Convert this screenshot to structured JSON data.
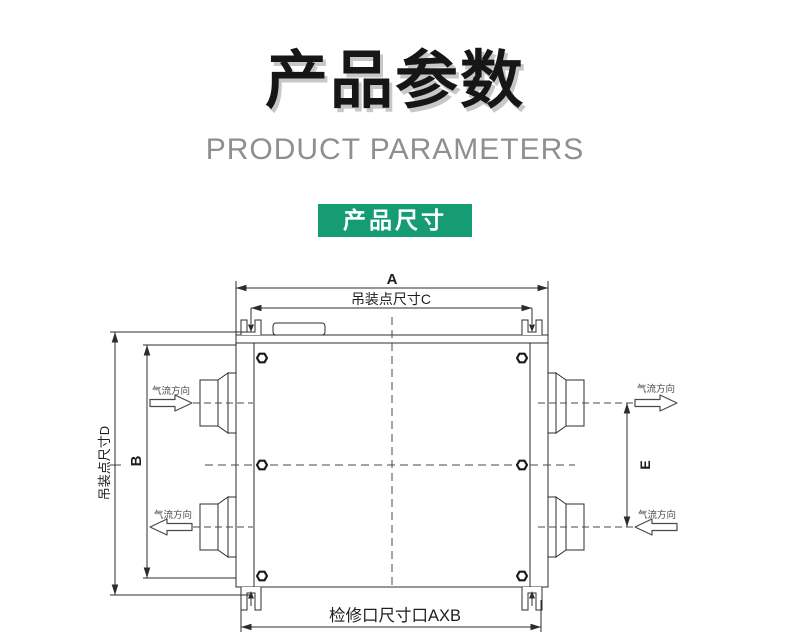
{
  "header": {
    "title": "产品参数",
    "subtitle": "PRODUCT PARAMETERS"
  },
  "section": {
    "badge": "产品尺寸"
  },
  "colors": {
    "accent_green": "#169c73",
    "title_black": "#161616",
    "subtitle_gray": "#8f8f8f",
    "drawing_line": "#2c2c2c"
  },
  "diagram": {
    "dim_overall_width": "A",
    "dim_hoist_point_width": "吊装点尺寸C",
    "dim_hoist_point_height": "吊装点尺寸D",
    "dim_body_height": "B",
    "dim_port_spacing": "E",
    "dim_access_port": "检修口尺寸口AXB",
    "airflow_label": "气流方向"
  }
}
